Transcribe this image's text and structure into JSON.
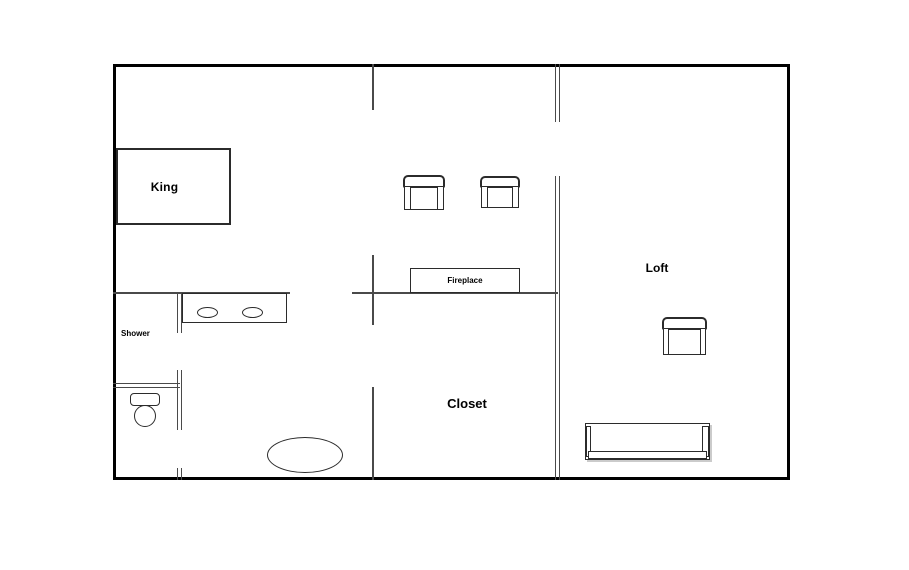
{
  "type": "floor-plan",
  "labels": {
    "king": "King",
    "shower": "Shower",
    "closet": "Closet",
    "loft": "Loft",
    "fireplace": "Fireplace"
  },
  "colors": {
    "background": "#ffffff",
    "outer_wall": "#000000",
    "interior_wall": "#4a4a4a",
    "furniture_outline": "#2b2b2b",
    "text": "#000000"
  }
}
